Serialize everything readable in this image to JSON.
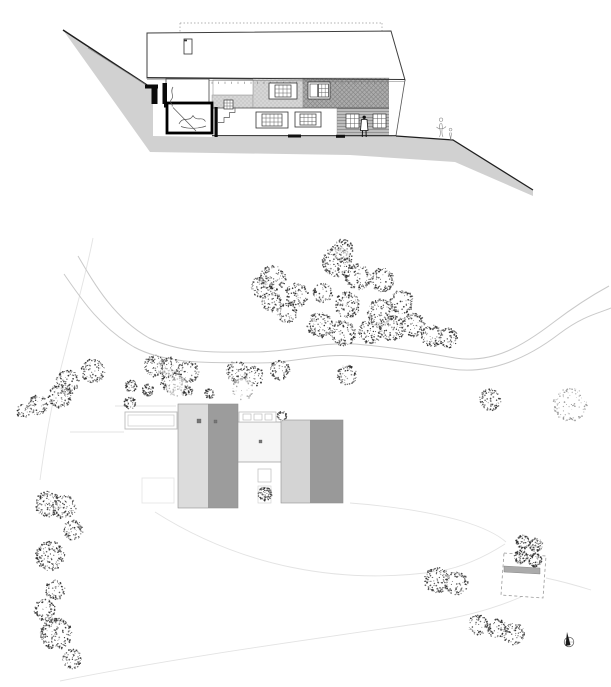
{
  "canvas": {
    "w": 611,
    "h": 687,
    "bg": "#ffffff"
  },
  "palette": {
    "terrain": "#d1d1d1",
    "line_dark": "#1f1f1f",
    "line_mid": "#555555",
    "line_road": "#c9c9c9",
    "line_faint": "#e3e3e3",
    "roof_fill": "#ffffff",
    "roof_stroke": "#3f3f3f",
    "stipple_bg": "#d6d6d6",
    "stipple_dot": "#9e9e9e",
    "hatch_bg": "#ababab",
    "hatch_line": "#828282",
    "siding_bg": "#bdbdbd",
    "siding_line": "#7d7d7d",
    "plan_light": "#dcdcdc",
    "plan_dark": "#9c9c9c",
    "plan_light2": "#d4d4d4",
    "plan_dark2": "#999999",
    "connector_fill": "#f5f5f5",
    "tree_dot": "#2e2e2e",
    "tree_dot_light": "#8f8f8f"
  },
  "section": {
    "terrain_poly": "63,30 150,87 153,87 153,136 215,137 395,136 453,140 533,190 533,196 455,162 350,155 150,152",
    "ground_lines": [
      {
        "d": "M63,30 L150,87",
        "w": 1.5,
        "light": false
      },
      {
        "d": "M88,48 L148,86",
        "w": 0.6,
        "light": true
      },
      {
        "d": "M396,136 L453,140 L533,190",
        "w": 1.3,
        "light": false
      }
    ],
    "dotted": [
      [
        180,
        23,
        382,
        23
      ],
      [
        180,
        23,
        180,
        33
      ],
      [
        382,
        23,
        382,
        31
      ]
    ],
    "roof_poly": "147,33 391,31 405,80 147,78",
    "roof_left_edge": [
      147,
      33,
      147,
      78
    ],
    "eave": {
      "main": "M147,77.5 L405,79.5",
      "sub": "M147,79.7 L405,81.7"
    },
    "ticks": {
      "x1": 212,
      "x2": 389,
      "y": 81.7,
      "step": 6.5,
      "len": 2.2
    },
    "chimney": [
      184,
      39,
      8,
      15
    ],
    "bands": {
      "stipple_low": [
        212,
        95,
        41,
        13
      ],
      "stipple_main": [
        253,
        78,
        50,
        30
      ],
      "hatch": [
        303,
        78,
        86,
        30
      ],
      "siding": [
        337,
        108,
        55,
        28
      ],
      "opening": [
        213,
        80,
        40,
        15
      ],
      "lower_wall": [
        253,
        108,
        84,
        28
      ],
      "corridor": [
        218,
        107,
        35,
        29
      ],
      "gable_poly": "389,78.5 405,80 396,135.7 389,135.7",
      "right_edge": "M405,80 L396,135.7"
    },
    "floor_line": [
      212,
      108,
      389,
      108
    ],
    "base_line": [
      212,
      135.7,
      396,
      135.7
    ],
    "base_marks": [
      [
        288,
        134.5,
        13,
        3
      ],
      [
        336,
        134.8,
        9,
        3
      ]
    ],
    "rooms": {
      "white_sliver": [
        156,
        85,
        8,
        18
      ],
      "upper": [
        166,
        79,
        43,
        27
      ],
      "upper_wall": [
        162.5,
        83,
        4.5,
        21
      ],
      "slab": [
        164,
        104,
        47,
        3.5
      ],
      "lower": [
        167,
        103,
        45,
        30
      ],
      "found_wall": [
        214.5,
        107,
        3.2,
        30
      ],
      "blk_h": [
        145,
        84.5,
        13,
        4
      ],
      "blk_v": [
        151.5,
        87,
        6,
        17
      ]
    },
    "sketches": [
      "M173,87 C169.5,92 175,96 171,100 C169,103 173.5,104.5 172,106.5",
      "M173,107.5 L196,131",
      "M179,124 C183,115.5 189,123 193,115.5 C197,122.5 202,115.5 205.5,121.5",
      "M181,126.5 C188,129 198,129 206,126",
      "M218,122.5 L224,122.5 L224,117.5 L229.5,117.5 L229.5,112.5 L235,112.5 L235,107.5"
    ],
    "windows": [
      {
        "f": [
          269,
          83,
          28,
          16
        ],
        "g": [
          275,
          85,
          16,
          12
        ],
        "c": 4,
        "r": 3
      },
      {
        "f": [
          308,
          82,
          22,
          17
        ],
        "g": [
          318.5,
          84,
          10,
          13
        ],
        "c": 3,
        "r": 3,
        "sash": [
          310,
          84,
          7.5,
          13
        ]
      },
      {
        "g": [
          224,
          100,
          9,
          9
        ],
        "c": 3,
        "r": 3
      },
      {
        "f": [
          256,
          112,
          32,
          16
        ],
        "g": [
          262,
          114,
          20,
          12
        ],
        "c": 5,
        "r": 3
      },
      {
        "f": [
          295,
          112,
          26,
          15
        ],
        "g": [
          300,
          114,
          16,
          11
        ],
        "c": 4,
        "r": 3
      },
      {
        "g": [
          346,
          114,
          13,
          14
        ],
        "c": 3,
        "r": 3
      },
      {
        "g": [
          373,
          114,
          13,
          14
        ],
        "c": 3,
        "r": 3
      }
    ],
    "person": {
      "head": [
        364.2,
        117.3,
        1.7
      ],
      "body": "M361.5,119.5 L367,119.5 L368,130.5 L360.5,130.5 Z",
      "legs": [
        [
          362.5,
          130.5,
          362.3,
          137
        ],
        [
          366,
          130.5,
          366.2,
          137
        ]
      ]
    },
    "figures": [
      "M441,121.5 a1.8,1.8 0 1 1 0.1,0",
      "M440.5,123 C437.5,127.5 442.5,131.5 439.5,137 M441.5,123 C444,127.5 440,131.5 443,137 M436.5,127 C439,129.5 443.5,129.5 446,126.5",
      "M450.5,131 a1.4,1.4 0 1 1 0.1,0",
      "M450,132.5 C448.5,135 451.5,137 450,140 M451,132.5 C452.5,135 449.5,137.5 451.5,140"
    ]
  },
  "plan": {
    "roads": [
      "M78,256 C95,285 114,318 149,338 C184,355 224,352 259,352 C294,351 320,342 355,344 C390,347 420,352 455,358 C494,364 524,345 554,322 C579,303 598,292 609,286",
      "M64,274 C82,300 99,326 134,347 C169,366 219,362 257,363 C295,363 320,353 355,356 C390,359 419,364 451,369 C491,375 529,357 559,334 C584,315 600,313 611,308"
    ],
    "faint_paths": [
      "M93,238 C85,280 70,330 58,380 C50,412 44,450 40,480",
      "M115,406 L176,406",
      "M70,432 L124,432",
      "M155,512 C240,566 340,586 440,571 C468,566 491,553 505,544",
      "M60,681 C180,657 300,641 430,622 C470,616 500,606 521,597",
      "M350,503 C390,506 430,512 462,521 C482,527 497,534 506,542",
      "M546,578 C560,581 575,585 591,590"
    ],
    "building": {
      "left_light": [
        178,
        404,
        30,
        104
      ],
      "left_dark": [
        208,
        404,
        30,
        104
      ],
      "left_outline": [
        178,
        404,
        60,
        104
      ],
      "right_light": [
        281,
        420,
        29,
        83
      ],
      "right_dark": [
        310,
        420,
        33,
        83
      ],
      "right_outline": [
        281,
        420,
        62,
        83
      ],
      "connector": [
        236,
        422,
        49,
        40
      ],
      "skylight_frame": [
        239,
        412,
        37,
        10
      ],
      "skylight_cells": [
        [
          243,
          414,
          8,
          6
        ],
        [
          254,
          414,
          8,
          6
        ],
        [
          265,
          414,
          7,
          6
        ]
      ],
      "pool_outer": [
        125,
        412,
        52,
        17
      ],
      "pool_inner": [
        128,
        415,
        46,
        11
      ],
      "court_sq1": [
        258,
        469,
        13,
        13
      ],
      "court_sq2": [
        258,
        486,
        13,
        17
      ],
      "terrace": [
        142,
        478,
        32,
        25
      ],
      "dots": [
        [
          197,
          419,
          4,
          4
        ],
        [
          214,
          420,
          3,
          3
        ],
        [
          259,
          440,
          3,
          3
        ]
      ]
    },
    "garage": {
      "outline": "504,553 546,556 543,598 501,595",
      "bar": "504,566 540,568 540,574 504,572"
    },
    "north": {
      "cx": 569,
      "cy": 642,
      "r": 4.8
    },
    "trees": [
      [
        273,
        278,
        13,
        1
      ],
      [
        297,
        295,
        12,
        1
      ],
      [
        337,
        262,
        15,
        1
      ],
      [
        343,
        250,
        11,
        1
      ],
      [
        358,
        277,
        13,
        1
      ],
      [
        382,
        280,
        12,
        1
      ],
      [
        323,
        293,
        10,
        1
      ],
      [
        347,
        305,
        13,
        1
      ],
      [
        380,
        312,
        13,
        1
      ],
      [
        402,
        302,
        12,
        1
      ],
      [
        320,
        325,
        13,
        1
      ],
      [
        343,
        333,
        13,
        1
      ],
      [
        370,
        332,
        12,
        1
      ],
      [
        392,
        328,
        13,
        1
      ],
      [
        413,
        325,
        12,
        1
      ],
      [
        432,
        336,
        11,
        1
      ],
      [
        448,
        338,
        10,
        1
      ],
      [
        287,
        313,
        10,
        1
      ],
      [
        262,
        287,
        11,
        1
      ],
      [
        272,
        302,
        10,
        1
      ],
      [
        68,
        382,
        12,
        1
      ],
      [
        60,
        396,
        12,
        1
      ],
      [
        93,
        371,
        12,
        1
      ],
      [
        155,
        366,
        11,
        1
      ],
      [
        172,
        381,
        12,
        1
      ],
      [
        38,
        405,
        10,
        1
      ],
      [
        23,
        411,
        7,
        1
      ],
      [
        131,
        386,
        6,
        0
      ],
      [
        148,
        390,
        6,
        0
      ],
      [
        130,
        403,
        6,
        0
      ],
      [
        170,
        367,
        10,
        1
      ],
      [
        188,
        372,
        11,
        1
      ],
      [
        177,
        387,
        11,
        2
      ],
      [
        188,
        391,
        5,
        0
      ],
      [
        209,
        394,
        5,
        0
      ],
      [
        237,
        372,
        11,
        1
      ],
      [
        254,
        376,
        10,
        1
      ],
      [
        243,
        389,
        11,
        2
      ],
      [
        280,
        370,
        10,
        1
      ],
      [
        347,
        375,
        10,
        1
      ],
      [
        490,
        400,
        11,
        1
      ],
      [
        570,
        405,
        17,
        2
      ],
      [
        282,
        416,
        5,
        0
      ],
      [
        265,
        494,
        7,
        0
      ],
      [
        48,
        504,
        13,
        1
      ],
      [
        64,
        507,
        12,
        1
      ],
      [
        73,
        530,
        10,
        1
      ],
      [
        50,
        556,
        15,
        1
      ],
      [
        55,
        590,
        10,
        1
      ],
      [
        45,
        610,
        11,
        1
      ],
      [
        56,
        634,
        16,
        1
      ],
      [
        72,
        659,
        10,
        1
      ],
      [
        437,
        580,
        13,
        1
      ],
      [
        456,
        583,
        12,
        1
      ],
      [
        478,
        625,
        10,
        1
      ],
      [
        497,
        629,
        10,
        1
      ],
      [
        514,
        634,
        11,
        1
      ],
      [
        523,
        542,
        7,
        0
      ],
      [
        536,
        545,
        7,
        0
      ],
      [
        521,
        557,
        7,
        0
      ],
      [
        535,
        560,
        7,
        0
      ]
    ]
  }
}
